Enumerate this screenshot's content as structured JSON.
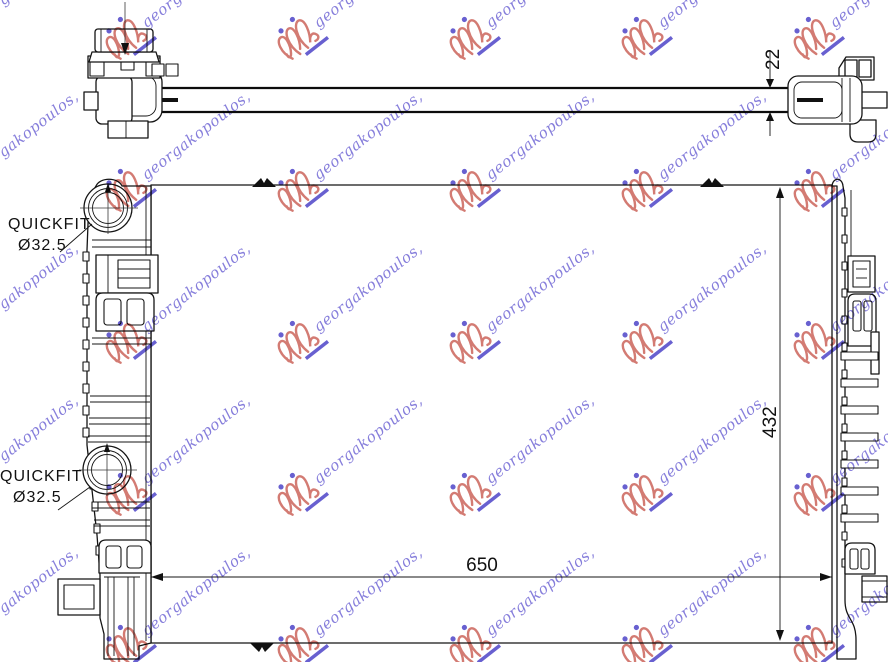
{
  "watermark": {
    "text": "georgakopoulos,",
    "text_color": "#7b72d8",
    "logo_color": "#cf6f66",
    "accent_color": "#5a52cc"
  },
  "top_view": {
    "dimension_depth": "22"
  },
  "front_view": {
    "dimension_width": "650",
    "dimension_height": "432",
    "quickfit_top": {
      "title": "QUICKFIT",
      "diameter": "Ø32.5"
    },
    "quickfit_bottom": {
      "title": "QUICKFIT",
      "diameter": "Ø32.5"
    }
  }
}
